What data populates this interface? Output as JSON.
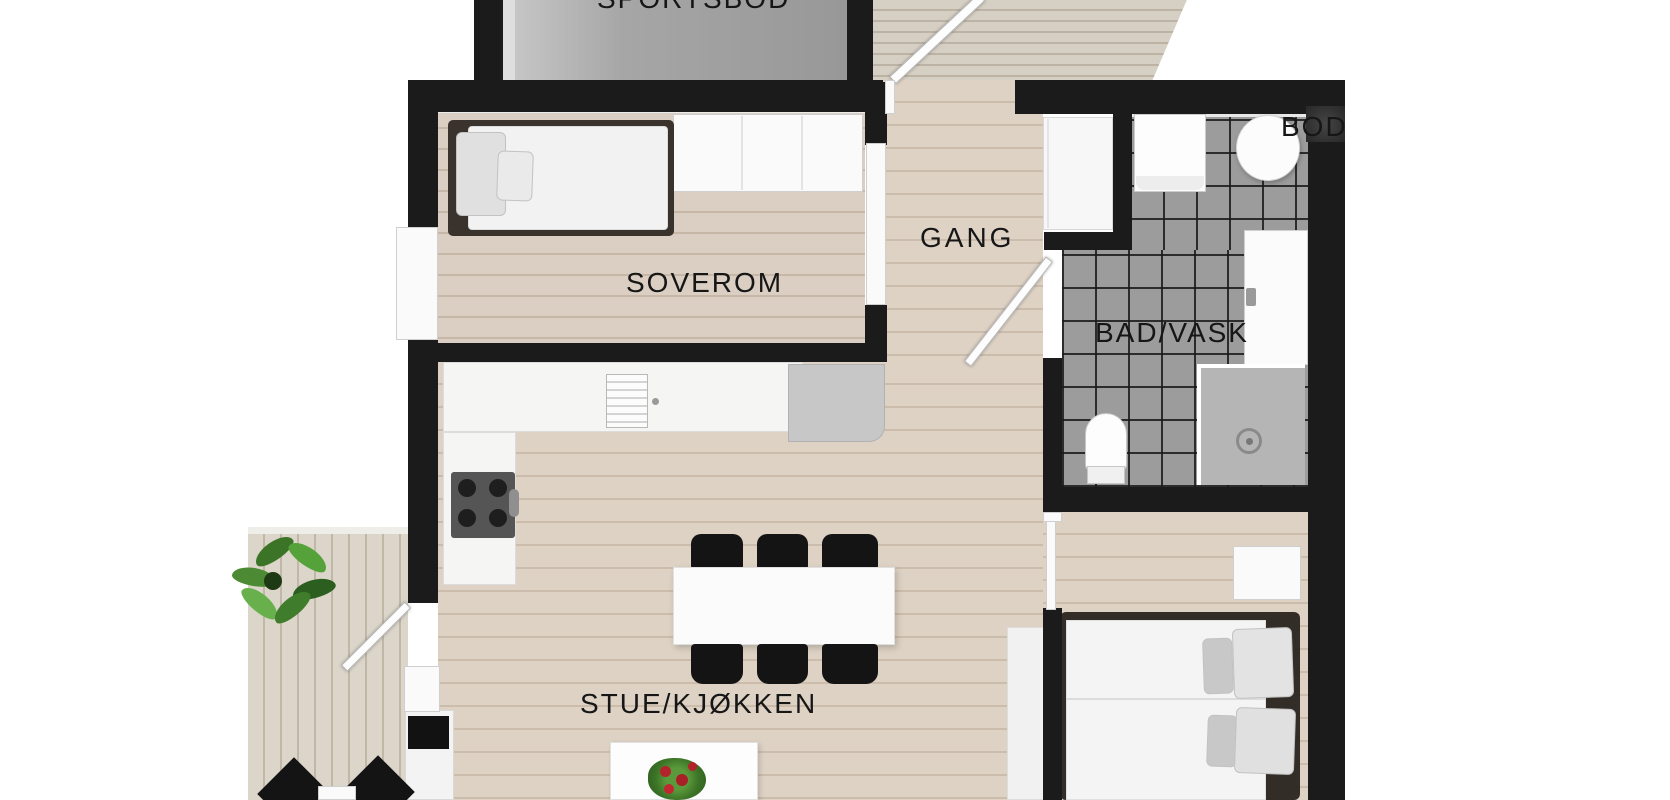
{
  "floorplan": {
    "rooms": [
      {
        "id": "sportsbod",
        "label": "SPORTSBOD"
      },
      {
        "id": "soverom",
        "label": "SOVEROM"
      },
      {
        "id": "gang",
        "label": "GANG"
      },
      {
        "id": "bod",
        "label": "BOD"
      },
      {
        "id": "bad-vask",
        "label": "BAD/VASK"
      },
      {
        "id": "stue-kjokken",
        "label": "STUE/KJØKKEN"
      }
    ],
    "colors": {
      "wall": "#1b1b1b",
      "wood_floor": "#d9cdbf",
      "tile_floor": "#9c9c9c",
      "deck": "#d2cbbf",
      "label_text": "#161616"
    }
  }
}
